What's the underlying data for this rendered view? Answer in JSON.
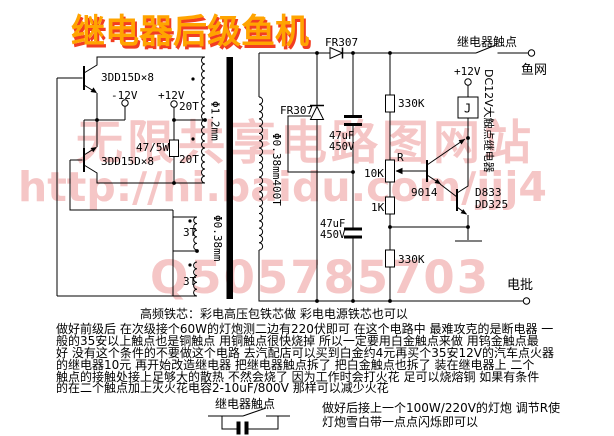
{
  "title": "继电器后级鱼机",
  "watermark": {
    "row1": "无限共享电路图网站",
    "row2": "http://hi.baidu.com/jjj4",
    "row3": "Q505785703"
  },
  "labels": {
    "q1": "3DD15D×8",
    "q2": "3DD15D×8",
    "v_neg": "-12V",
    "v_pos": "+12V",
    "r_damp": "47/5W",
    "p20t_top": "20T",
    "p20t_bot": "20T",
    "fb3t_top": "3T",
    "fb3t_bot": "3T",
    "wire_primary": "Φ1.2mm",
    "wire_feedback": "Φ0.38mm",
    "wire_secondary": "Φ0.38mm400T",
    "d_series": "FR307",
    "d_shunt": "FR307",
    "c1a": "47uF",
    "c1b": "450V",
    "c2a": "47uF",
    "c2b": "450V",
    "r_top": "330K",
    "r_pot_name": "R",
    "r_pot": "10K",
    "r_mid": "1K",
    "r_bot": "330K",
    "q3": "9014",
    "q4a": "D833",
    "q4b": "DD325",
    "relay_v": "+12V",
    "relay_j": "J",
    "relay_desc": "DC12V大触点继电器",
    "contact": "继电器触点",
    "out_net": "鱼网",
    "out_rod": "电批"
  },
  "notes": [
    "高频铁芯：彩电高压包铁芯做 彩电电源铁芯也可以",
    "做好前级后 在次级接个60W的灯炮测二边有220伏即可 在这个电路中 最难攻克的是断电器 一",
    "般的35安以上触点也是铜触点 用铜触点很快烧掉 所以一定要用白金触点来做 用钨金触点最",
    "好 没有这个条件的不要做这个电路 去汽配店可以买到白金约4元再买个35安12V的汽车点火器",
    "的继电器10元 再开始改造继电器 把继电器触点拆了 把白金触点也拆了 装在继电器上 二个",
    "触点的接触处接上足够大的散热 不然会烧了 因为工作时会打火花 足可以烧熔铜 如果有条件",
    "的在二个触点加上灭火花电容2-10uF/800V 那样可以减少火花"
  ],
  "footer": {
    "contact": "继电器触点",
    "tip1": "做好后接上一个100W/220V的灯炮 调节R使",
    "tip2": "灯炮雪白带一点点闪烁即可以"
  },
  "colors": {
    "title_fill": "#ffa400",
    "title_shadow": "#f23d21",
    "watermark": "#f5c6c6",
    "line": "#000000"
  }
}
